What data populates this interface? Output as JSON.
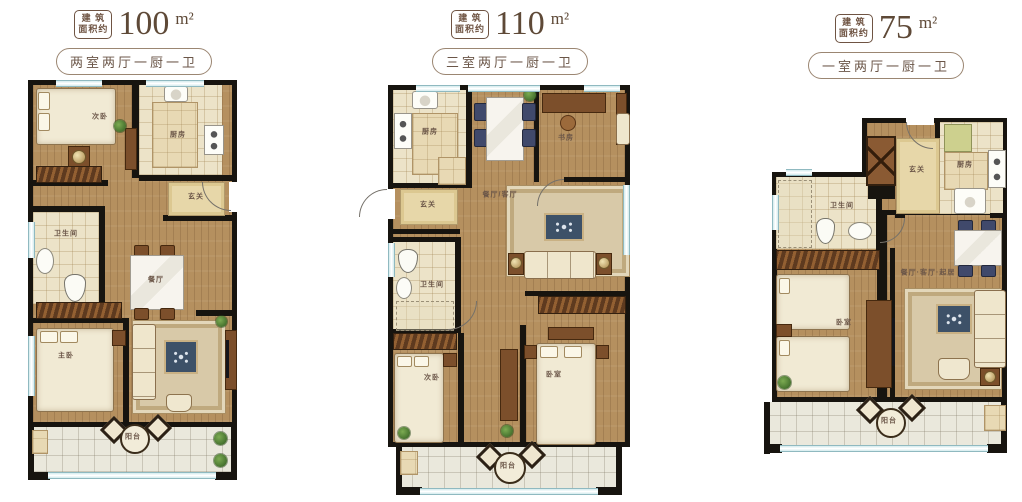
{
  "colors": {
    "wall": "#17140f",
    "wood_floor": "#b5905f",
    "tile_floor": "#ece3c8",
    "balcony_tile": "#eae8dc",
    "window_blue": "#cfe4e8",
    "label_text": "#6b5648",
    "header_text": "#6f5443"
  },
  "plans": [
    {
      "id": "plan-100",
      "badge": {
        "line1": "建 筑",
        "line2": "面积约"
      },
      "area": {
        "value": "100",
        "unit": "m²"
      },
      "layout": "两室两厅一厨一卫",
      "rooms": {
        "bedroom_secondary": "次卧",
        "kitchen": "厨房",
        "entry": "玄关",
        "bathroom": "卫生间",
        "dining": "餐厅",
        "bedroom_master": "主卧",
        "balcony": "阳台"
      }
    },
    {
      "id": "plan-110",
      "badge": {
        "line1": "建 筑",
        "line2": "面积约"
      },
      "area": {
        "value": "110",
        "unit": "m²"
      },
      "layout": "三室两厅一厨一卫",
      "rooms": {
        "kitchen": "厨房",
        "study": "书房",
        "living_dining": "餐厅/客厅",
        "entry": "玄关",
        "bathroom": "卫生间",
        "bedroom_secondary": "次卧",
        "bedroom": "卧室",
        "balcony": "阳台"
      }
    },
    {
      "id": "plan-75",
      "badge": {
        "line1": "建 筑",
        "line2": "面积约"
      },
      "area": {
        "value": "75",
        "unit": "m²"
      },
      "layout": "一室两厅一厨一卫",
      "rooms": {
        "entry": "玄关",
        "kitchen": "厨房",
        "bathroom": "卫生间",
        "living_dining": "餐厅·客厅·起居",
        "bedroom": "卧室",
        "balcony": "阳台"
      }
    }
  ]
}
